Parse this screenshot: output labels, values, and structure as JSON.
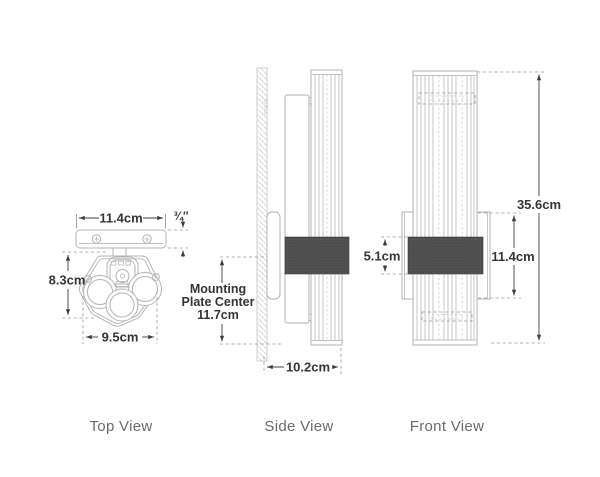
{
  "drawing": {
    "view_labels": {
      "top": "Top View",
      "side": "Side View",
      "front": "Front View"
    },
    "dims": {
      "plate_width": "11.4cm",
      "plate_thickness": "¾″",
      "head_depth": "8.3cm",
      "head_width": "9.5cm",
      "mounting_plate_center_line1": "Mounting",
      "mounting_plate_center_line2": "Plate Center",
      "mounting_plate_center_line3": "11.7cm",
      "projection": "10.2cm",
      "band_height": "5.1cm",
      "backplate_height": "11.4cm",
      "overall_height": "35.6cm"
    },
    "wall_label": "WALL",
    "colors": {
      "linework": "#b3b3b3",
      "dimension": "#3a3a3a",
      "band_fill": "#4d4d4d",
      "view_label": "#6a6a6a",
      "background": "#ffffff"
    }
  }
}
